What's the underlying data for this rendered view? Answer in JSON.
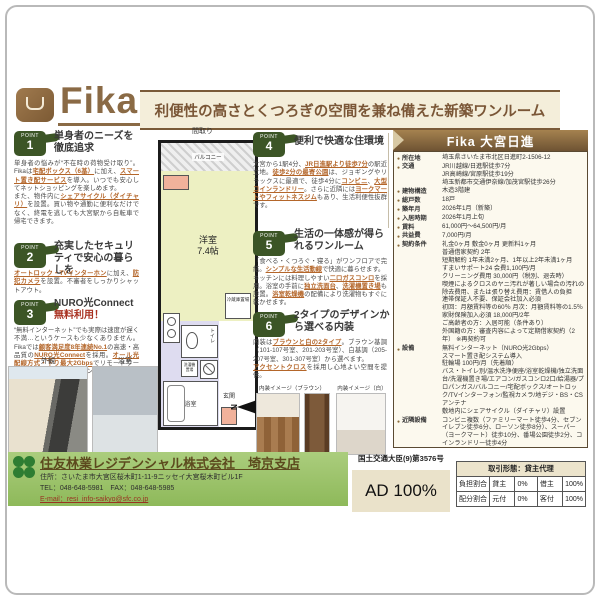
{
  "header": {
    "logo": "Fika",
    "tagline": "利便性の高さとくつろぎの空間を兼ね備えた新築ワンルーム"
  },
  "points": [
    {
      "num": "1",
      "label": "POINT",
      "title": "単身者のニーズを徹底追求",
      "body": [
        {
          "t": "単身者の悩みが“不在時の荷物受け取り”。Fikaは"
        },
        {
          "t": "宅配ボックス（6基）",
          "e": true
        },
        {
          "t": "に加え、"
        },
        {
          "t": "スマート置き配サービス",
          "e": true
        },
        {
          "t": "を導入。いつでも安心してネットショッピングを楽しめます。\nまた、物件内に"
        },
        {
          "t": "シェアサイクル（ダイチャリ）",
          "e": true
        },
        {
          "t": "を設置。買い物や通勤に便利なだけでなく、終電を逃しても大宮駅から自転車で帰宅できます。"
        }
      ]
    },
    {
      "num": "2",
      "label": "POINT",
      "title": "充実したセキュリティで安心の暮らしを",
      "body": [
        {
          "t": "オートロック・TVインターホン",
          "e": true
        },
        {
          "t": "に加え、"
        },
        {
          "t": "防犯カメラ",
          "e": true
        },
        {
          "t": "を設置。不審者をしっかりシャットアウト。"
        }
      ]
    },
    {
      "num": "3",
      "label": "POINT",
      "title": "NURO光Connect",
      "title2": "無料利用！",
      "body": [
        {
          "t": "“無料インターネット”でも実際は速度が遅く不満…というケースも少なくありません。Fikaでは"
        },
        {
          "t": "顧客満足度8年連続No.1",
          "e": true
        },
        {
          "t": "の高速・高品質の"
        },
        {
          "t": "NURO光Connect",
          "e": true
        },
        {
          "t": "を採用。"
        },
        {
          "t": "オール光配線方式・下り最大2Gbps",
          "e": true
        },
        {
          "t": "でリモートワークはもちろん、動画やオンラインゲームも快適に楽しめます。"
        }
      ]
    },
    {
      "num": "4",
      "label": "POINT",
      "title": "便利で快適な住環境",
      "body": [
        {
          "t": "大宮から1駅4分、"
        },
        {
          "t": "JR日進駅より徒歩7分",
          "e": true
        },
        {
          "t": "の駅近立地。"
        },
        {
          "t": "徒歩2分の最寄公園",
          "e": true
        },
        {
          "t": "は、ジョギングやリラックスに最適で、徒歩4分に"
        },
        {
          "t": "コンビニ",
          "e": true
        },
        {
          "t": "、"
        },
        {
          "t": "大型コインランドリー",
          "e": true
        },
        {
          "t": "。さらに近隣には"
        },
        {
          "t": "ヨークマートやフィットネスジム",
          "e": true
        },
        {
          "t": "もあり、生活利便性抜群です。"
        }
      ]
    },
    {
      "num": "5",
      "label": "POINT",
      "title": "生活の一体感が得られるワンルーム",
      "body": [
        {
          "t": "「食べる・くつろぐ・寝る」がワンフロアで完結。"
        },
        {
          "t": "シンプルな生活動線",
          "e": true
        },
        {
          "t": "で快適に暮らせます。\nキッチンには料理しやすい"
        },
        {
          "t": "二口ガスコンロ",
          "e": true
        },
        {
          "t": "を採用。浴室の手前に"
        },
        {
          "t": "独立洗面台",
          "e": true
        },
        {
          "t": "、"
        },
        {
          "t": "洗濯機置き場",
          "e": true
        },
        {
          "t": "も設置。"
        },
        {
          "t": "浴室乾燥機",
          "e": true
        },
        {
          "t": "の配備により洗濯物もすぐに乾かせます。"
        }
      ]
    },
    {
      "num": "6",
      "label": "POINT",
      "title": "2タイプのデザインから選べる内装",
      "body": [
        {
          "t": "内装は"
        },
        {
          "t": "ブラウンと白の2タイプ",
          "e": true
        },
        {
          "t": "。ブラウン基調（101-107号室、201-203号室）、白基調（205-207号室、301-307号室）から選べます。\n"
        },
        {
          "t": "アクセントクロス",
          "e": true
        },
        {
          "t": "を採用し心地よい空間を提供。"
        }
      ]
    }
  ],
  "floorplan": {
    "label": "間取り",
    "balcony": "バルコニー",
    "room": "洋室",
    "size": "7.4帖",
    "fridge": "冷蔵庫置場",
    "toilet": "トイレ",
    "washer": "洗濯機置場",
    "bath": "浴室",
    "entrance": "玄関",
    "north": "N"
  },
  "photos": {
    "exterior_label": "外観",
    "bath_label": "浴室",
    "interior_brown_caption": "内装イメージ（ブラウン）",
    "interior_white_caption": "内装イメージ（白）"
  },
  "property": {
    "title": "Fika 大宮日進",
    "rows": [
      {
        "label": "所在地",
        "value": "埼玉県さいたま市北区日進町2-1506-12"
      },
      {
        "label": "交通",
        "value": "JR川越線/日進駅徒歩7分\nJR高崎線/宮原駅徒歩19分\n埼玉新都市交通伊奈線/加茂宮駅徒歩26分"
      },
      {
        "label": "建物構造",
        "value": "木造3階建"
      },
      {
        "label": "総戸数",
        "value": "18戸"
      },
      {
        "label": "築年月",
        "value": "2026年1月（新築）"
      },
      {
        "label": "入居時期",
        "value": "2026年1月上旬"
      },
      {
        "label": "賃料",
        "value": "61,000円～64,500円/月"
      },
      {
        "label": "共益費",
        "value": "7,000円/月"
      },
      {
        "label": "契約条件",
        "value": "礼金0ヶ月 敷金0ヶ月 更新料1ヶ月\n普通借家契約 2年\n短期解約 1年未満2ヶ月、1年以上2年未満1ヶ月\nすまいサポート24 会費1,100円/月\nクリーニング費用 30,000円（税別、退去時）\n喫煙によるクロスのヤニ汚れが著しい場合の汚れの除去費用、または張り替え費用：賃借人の負担\n連帯保証人不要、保証会社加入必須\n初回：月額賃料等の60％ 月次：月額賃料等の1.5％\n家財保険加入必須 18,000円/2年\nご高齢者の方：入居可能（条件あり）\n外国籍の方：審査内容によって定期借家契約（2年） ※再契約可"
      },
      {
        "label": "設備",
        "value": "無料インターネット（NURO光2Gbps）\nスマート置き配システム導入\n駐輪場 100円/月（先着順）\nバス・トイレ別/温水洗浄便座/浴室乾燥機/独立洗面台/洗濯機置き場/エアコン/ガスコンロ2口/給湯器/プロパンガス/バルコニー/宅配ボックス/オートロック/TVインターフォン/監視カメラ/地デジ・BS・CSアンテナ\n敷地内にシェアサイクル（ダイチャリ）設置"
      },
      {
        "label": "近隣設備",
        "value": "コンビニ複数（ファミリーマート徒歩4分、セブンイレブン徒歩6分、ローソン徒歩8分）、スーパー（ヨークマート）徒歩10分、番場公園徒歩2分、コインランドリー徒歩4分"
      },
      {
        "label": "必要書類",
        "value": "顔写真付き身分証明書コピー（契約者、入居者）"
      }
    ]
  },
  "footer": {
    "company": "住友林業レジデンシャル株式会社　埼京支店",
    "license": "国土交通大臣(9)第3576号",
    "address": "住所：さいたま市大宮区桜木町1-11-9ニッセイ大宮桜木町ビル1F",
    "tel": "TEL：048-648-5981　FAX：048-648-5985",
    "email": "E-mail：resi_info-saikyo@sfc.co.jp",
    "ad": "AD 100%",
    "deal_table": {
      "header": "取引形態：貸主代理",
      "rows": [
        [
          "負担割合",
          "貸主",
          "0%",
          "借主",
          "100%"
        ],
        [
          "配分割合",
          "元付",
          "0%",
          "客付",
          "100%"
        ]
      ]
    }
  }
}
